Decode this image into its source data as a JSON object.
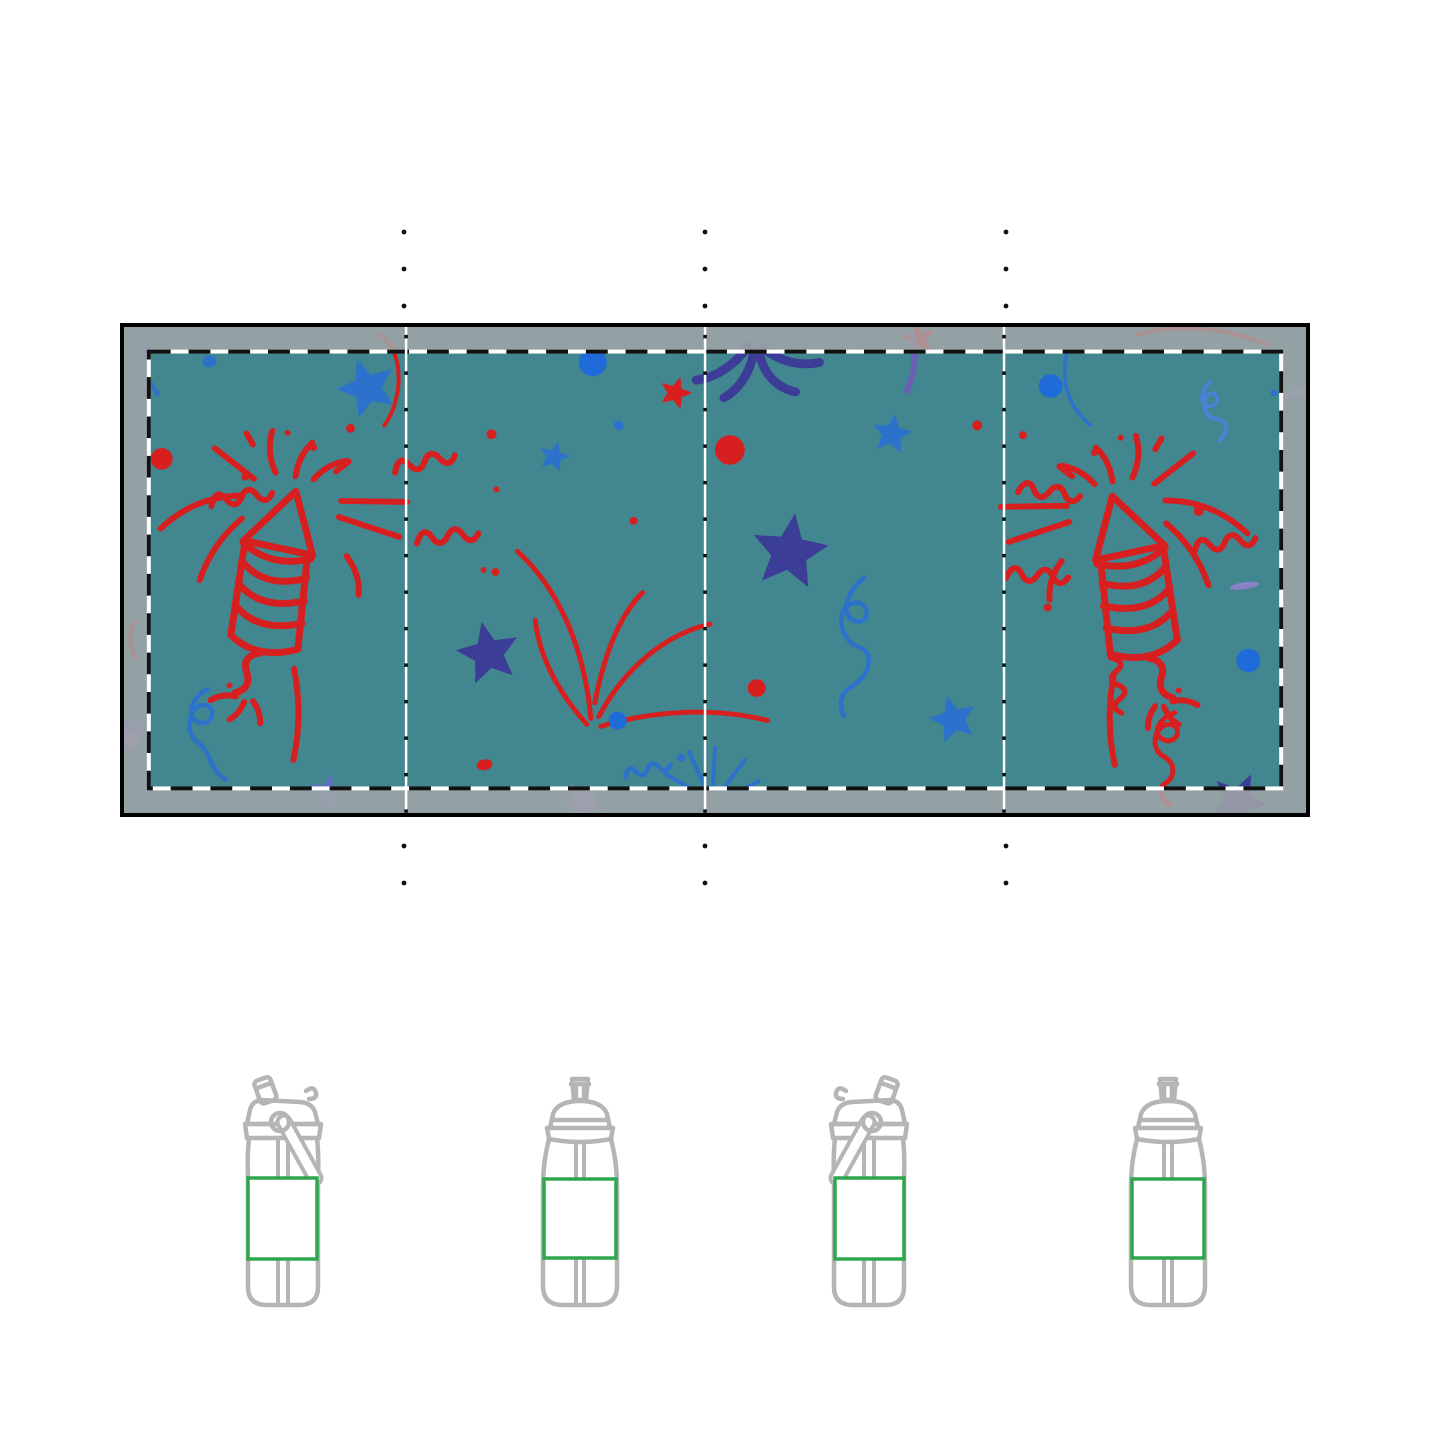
{
  "page": {
    "background_color": "#FFFFFF"
  },
  "design_area": {
    "background_color": "#42868F",
    "border_color": "#000000",
    "bleed_overlay_color": "rgba(164,167,168,0.84)",
    "safe_area_dash_black": "#111111",
    "safe_area_dash_white": "#FFFFFF",
    "panel_count": 4,
    "pattern": {
      "name": "fireworks-celebration-doodle",
      "red": "#D81F1F",
      "blue": "#2C72CC",
      "bright_blue": "#1E6BD9",
      "navy": "#3B3D96",
      "purple": "#7F77C2"
    }
  },
  "guides": {
    "dot_color": "#111111",
    "divider_columns": 3
  },
  "print_area": {
    "outline_color": "#2EA64E",
    "fill_color": "#FFFFFF"
  },
  "products": {
    "outline_color": "#B5B5B5",
    "items": [
      {
        "style": "flip-top-bottle-with-handle",
        "variant": "handle-right"
      },
      {
        "style": "sport-spout-bottle",
        "variant": "front"
      },
      {
        "style": "flip-top-bottle-with-handle",
        "variant": "handle-left"
      },
      {
        "style": "sport-spout-bottle",
        "variant": "front-mirrored"
      }
    ]
  }
}
